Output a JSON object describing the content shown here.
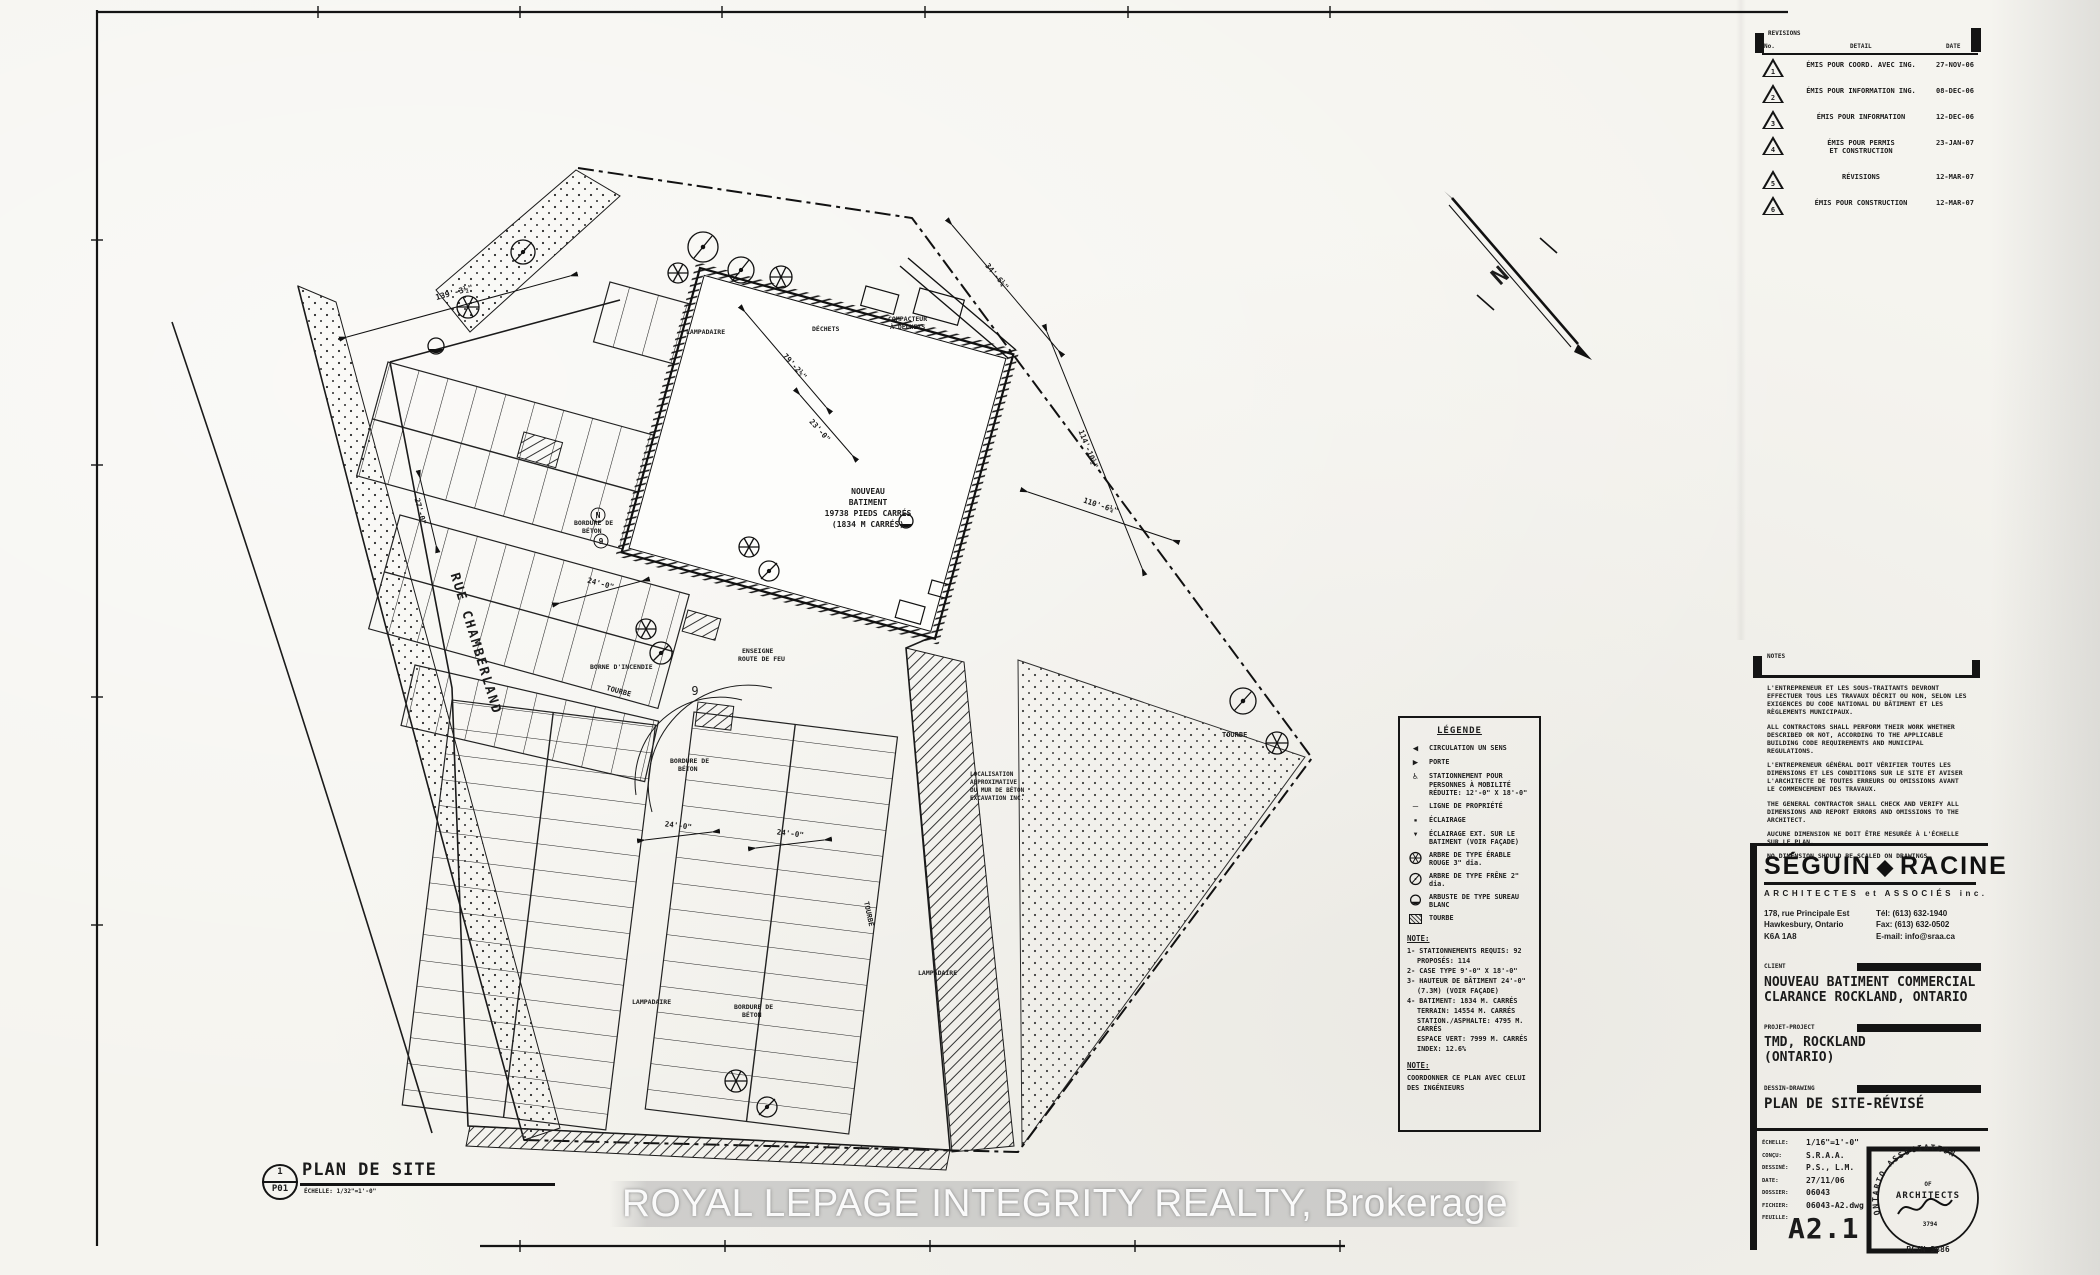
{
  "revisions": {
    "title": "REVISIONS",
    "col_no": "No.",
    "col_detail": "DETAIL",
    "col_date": "DATE",
    "rows": [
      {
        "no": "1",
        "detail": "ÉMIS POUR COORD. AVEC ING.",
        "detail2": "",
        "date": "27-NOV-06"
      },
      {
        "no": "2",
        "detail": "ÉMIS POUR INFORMATION ING.",
        "detail2": "",
        "date": "08-DEC-06"
      },
      {
        "no": "3",
        "detail": "ÉMIS POUR INFORMATION",
        "detail2": "",
        "date": "12-DEC-06"
      },
      {
        "no": "4",
        "detail": "ÉMIS POUR PERMIS",
        "detail2": "ET CONSTRUCTION",
        "date": "23-JAN-07"
      },
      {
        "no": "5",
        "detail": "RÉVISIONS",
        "detail2": "",
        "date": "12-MAR-07"
      },
      {
        "no": "6",
        "detail": "ÉMIS POUR CONSTRUCTION",
        "detail2": "",
        "date": "12-MAR-07"
      }
    ]
  },
  "notes_block": {
    "title": "NOTES",
    "paragraphs": [
      "L'ENTREPRENEUR ET LES SOUS-TRAITANTS DEVRONT EFFECTUER TOUS LES TRAVAUX DÉCRIT OU NON, SELON LES EXIGENCES DU CODE NATIONAL DU BÂTIMENT ET LES RÈGLEMENTS MUNICIPAUX.",
      "ALL CONTRACTORS SHALL PERFORM THEIR WORK WHETHER DESCRIBED OR NOT, ACCORDING TO THE APPLICABLE BUILDING CODE REQUIREMENTS AND MUNICIPAL REGULATIONS.",
      "L'ENTREPRENEUR GÉNÉRAL DOIT VÉRIFIER TOUTES LES DIMENSIONS ET LES CONDITIONS SUR LE SITE ET AVISER L'ARCHITECTE DE TOUTES ERREURS OU OMISSIONS AVANT LE COMMENCEMENT DES TRAVAUX.",
      "THE GENERAL CONTRACTOR SHALL CHECK AND VERIFY ALL DIMENSIONS AND REPORT ERRORS AND OMISSIONS TO THE ARCHITECT.",
      "AUCUNE DIMENSION NE DOIT ÊTRE MESURÉE À L'ÉCHELLE SUR LE PLAN.",
      "NO DIMENSION SHOULD BE SCALED ON DRAWINGS."
    ]
  },
  "firm": {
    "name_1": "SÉGUIN",
    "diamond": "◆",
    "name_2": "RACINE",
    "tagline": "ARCHITECTES et ASSOCIÉS inc.",
    "address": [
      "178, rue Principale Est",
      "Hawkesbury, Ontario",
      "K6A 1A8"
    ],
    "contact": [
      "Tél: (613) 632-1940",
      "Fax: (613) 632-0502",
      "E-mail: info@sraa.ca"
    ]
  },
  "titleblock": {
    "client_label": "CLIENT",
    "client_1": "NOUVEAU BATIMENT COMMERCIAL",
    "client_2": "CLARANCE ROCKLAND, ONTARIO",
    "project_label": "PROJET-PROJECT",
    "project_1": "TMD, ROCKLAND",
    "project_2": "(ONTARIO)",
    "drawing_label": "DESSIN-DRAWING",
    "drawing": "PLAN DE SITE-RÉVISÉ",
    "fields": [
      {
        "label": "ÉCHELLE:",
        "value": "1/16\"=1'-0\""
      },
      {
        "label": "CONÇU:",
        "value": "S.R.A.A."
      },
      {
        "label": "DESSINÉ:",
        "value": "P.S., L.M."
      },
      {
        "label": "DATE:",
        "value": "27/11/06"
      },
      {
        "label": "DOSSIER:",
        "value": "06043"
      },
      {
        "label": "FICHIER:",
        "value": "06043-A2.dwg"
      },
      {
        "label": "FEUILLE:",
        "value": ""
      }
    ],
    "sheet_number": "A2.1"
  },
  "stamp": {
    "arc_text": "ONTARIO ASSOCIATION",
    "of": "OF",
    "architects": "ARCHITECTS",
    "number": "3794",
    "bcin": "BCIN 3886"
  },
  "legend": {
    "title": "LÉGENDE",
    "entries": [
      {
        "glyph": "◀",
        "label": "CIRCULATION UN SENS"
      },
      {
        "glyph": "▶",
        "label": "PORTE"
      },
      {
        "glyph": "♿",
        "label": "STATIONNEMENT POUR PERSONNES À MOBILITÉ RÉDUITE: 12'-0\" X 18'-0\""
      },
      {
        "glyph": "—",
        "label": "LIGNE DE PROPRIÉTÉ"
      },
      {
        "glyph": "▪",
        "label": "ÉCLAIRAGE"
      },
      {
        "glyph": "▼",
        "label": "ÉCLAIRAGE EXT. SUR LE BATIMENT (VOIR FAÇADE)"
      },
      {
        "glyph": "",
        "label": "ARBRE DE TYPE ÉRABLE ROUGE 3\" dia."
      },
      {
        "glyph": "",
        "label": "ARBRE DE TYPE FRÊNE 2\" dia."
      },
      {
        "glyph": "",
        "label": "ARBUSTE DE TYPE SUREAU BLANC"
      },
      {
        "glyph": "",
        "label": "TOURBE"
      }
    ],
    "note1": {
      "title": "NOTE:",
      "lines": [
        "1- STATIONNEMENTS REQUIS: 92",
        "PROPOSÉS: 114",
        "2- CASE TYPE 9'-0\" X 18'-0\"",
        "3- HAUTEUR DE BÂTIMENT 24'-0\"",
        "(7.3M) (VOIR FAÇADE)",
        "4- BATIMENT: 1834 M. CARRÉS",
        "TERRAIN: 14554 M. CARRÉS",
        "STATION./ASPHALTE: 4795 M. CARRÉS",
        "ESPACE VERT: 7999 M. CARRÉS",
        "INDEX: 12.6%"
      ]
    },
    "note2": {
      "title": "NOTE:",
      "lines": [
        "COORDONNER CE PLAN AVEC CELUI",
        "DES INGÉNIEURS"
      ]
    }
  },
  "viewref": {
    "number": "1",
    "sheet": "P01",
    "title": "PLAN DE SITE",
    "scale": "ÉCHELLE: 1/32\"=1'-0\""
  },
  "watermark": {
    "text": "ROYAL LEPAGE INTEGRITY REALTY, Brokerage"
  },
  "plan": {
    "texts": [
      {
        "t": "RUE CHAMBERLAND"
      },
      {
        "t": "NOUVEAU"
      },
      {
        "t": "BATIMENT"
      },
      {
        "t": "19738 PIEDS CARRÉS"
      },
      {
        "t": "(1834 M CARRÉS)"
      },
      {
        "t": "TOURBE"
      },
      {
        "t": "TOURBE"
      },
      {
        "t": "TOURBE"
      },
      {
        "t": "LAMPADAIRE"
      },
      {
        "t": "LAMPADAIRE"
      },
      {
        "t": "LAMPADAIRE"
      },
      {
        "t": "DÉCHETS"
      },
      {
        "t": "COMPACTEUR"
      },
      {
        "t": "À DÉCHETS"
      },
      {
        "t": "BORNE D'INCENDIE"
      },
      {
        "t": "ENSEIGNE"
      },
      {
        "t": "ROUTE DE FEU"
      },
      {
        "t": "BORDURE DE"
      },
      {
        "t": "BÉTON"
      },
      {
        "t": "BORDURE DE"
      },
      {
        "t": "BÉTON"
      },
      {
        "t": "BORDURE DE"
      },
      {
        "t": "BÉTON"
      },
      {
        "t": "LOCALISATION"
      },
      {
        "t": "APPROXIMATIVE"
      },
      {
        "t": "DU MUR DE BÉTON"
      },
      {
        "t": "EXCAVATION INC."
      },
      {
        "t": "139'-3½\""
      },
      {
        "t": "79'-2½\""
      },
      {
        "t": "23'-0\""
      },
      {
        "t": "34'-6¼\""
      },
      {
        "t": "114'-10½\""
      },
      {
        "t": "110'-6¼\""
      },
      {
        "t": "24'-0\""
      },
      {
        "t": "24'-0\""
      },
      {
        "t": "24'-0\""
      },
      {
        "t": "27'-0\""
      },
      {
        "t": "N"
      },
      {
        "t": "9"
      },
      {
        "t": "9"
      },
      {
        "t": "♿"
      }
    ]
  }
}
